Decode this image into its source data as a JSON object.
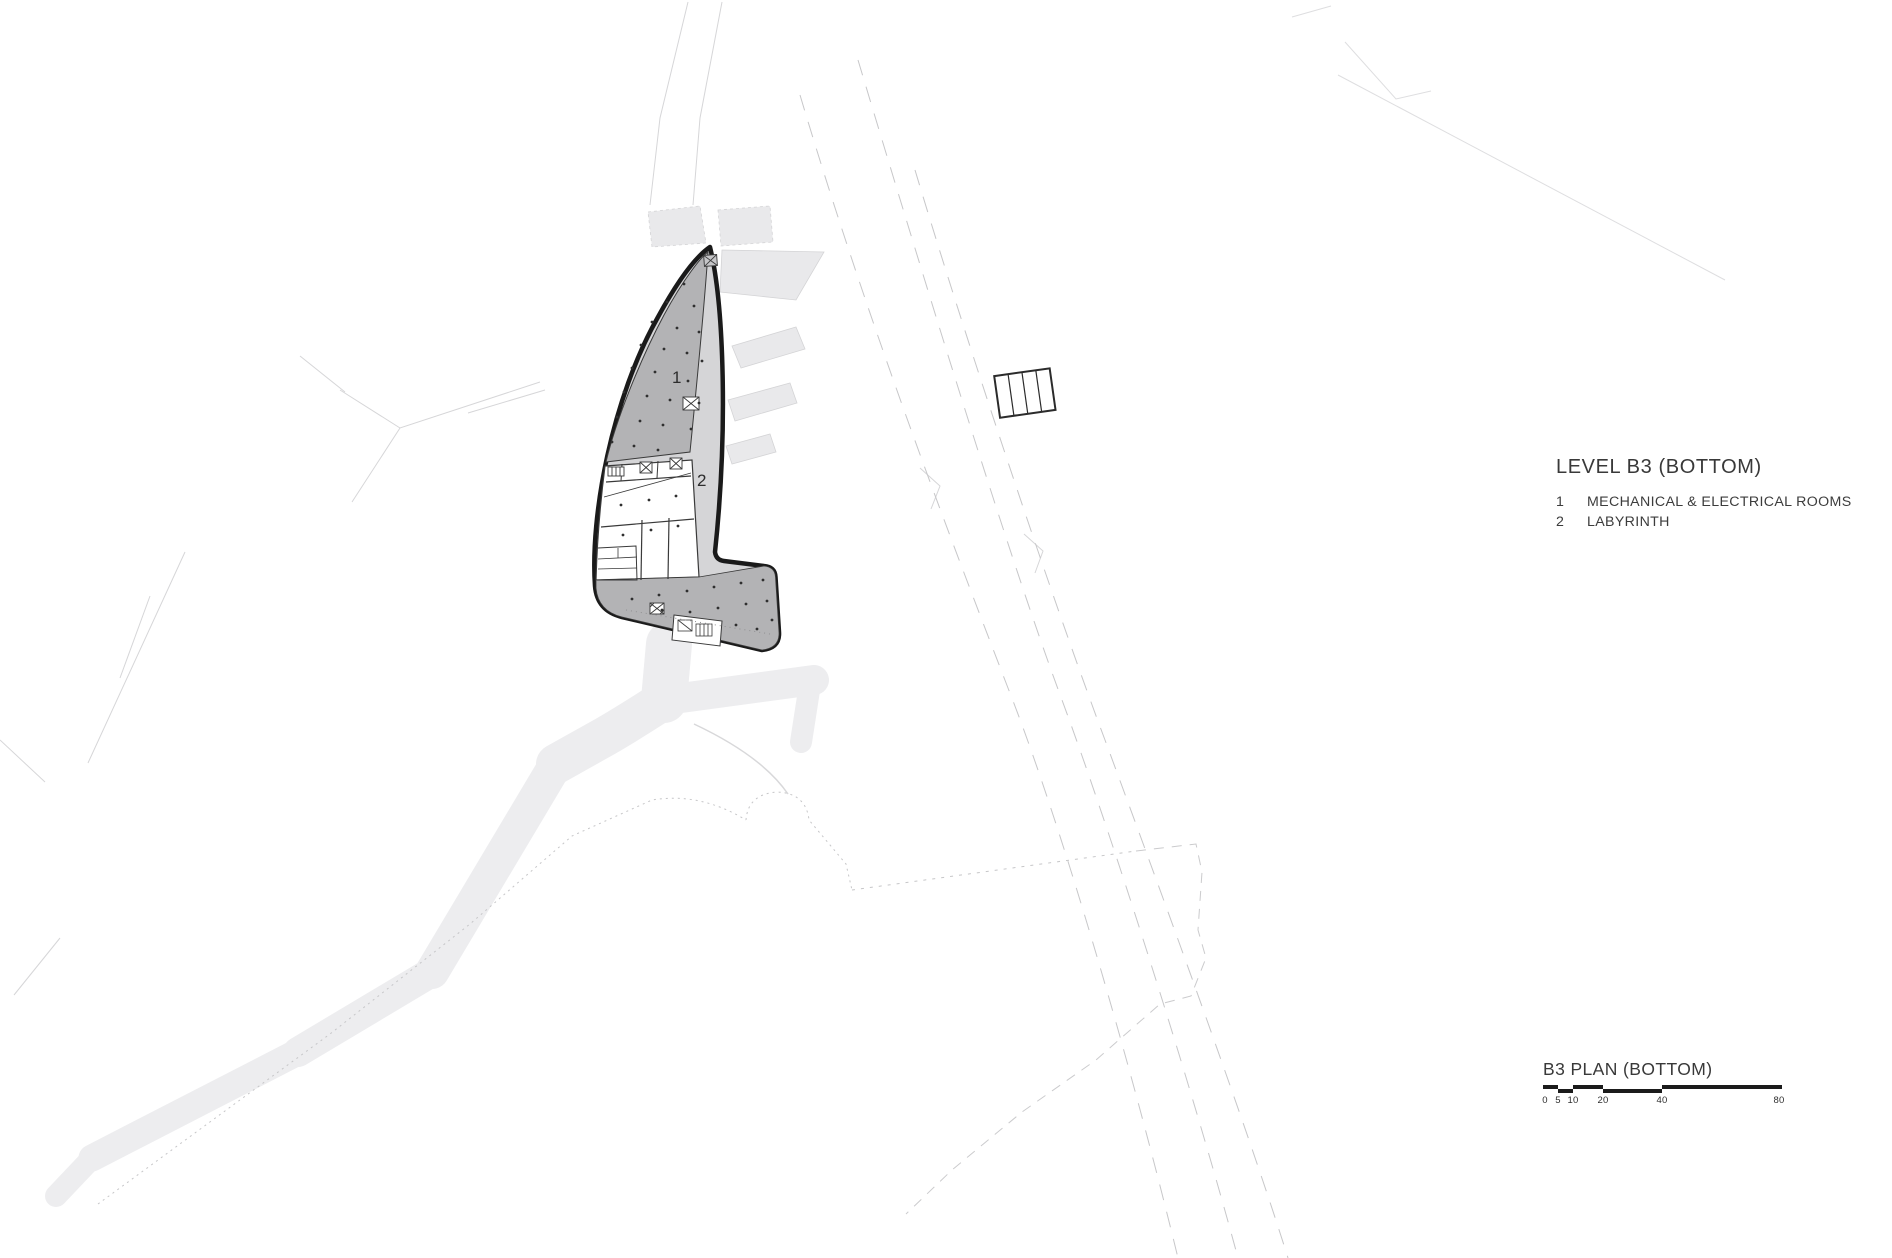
{
  "legend": {
    "title": "LEVEL B3 (BOTTOM)",
    "items": [
      {
        "num": "1",
        "label": "MECHANICAL & ELECTRICAL ROOMS"
      },
      {
        "num": "2",
        "label": "LABYRINTH"
      }
    ]
  },
  "plan": {
    "labels": {
      "mechanical": "1",
      "labyrinth": "2"
    }
  },
  "footer": {
    "title": "B3 PLAN (BOTTOM)",
    "scale_ticks": [
      "0",
      "5",
      "10",
      "20",
      "40",
      "80"
    ]
  },
  "colors": {
    "outline": "#1a1a1a",
    "room_dark": "#b3b3b5",
    "corridor_light": "#d5d5d7",
    "site_path": "#ededef",
    "text": "#3c3c3c"
  }
}
